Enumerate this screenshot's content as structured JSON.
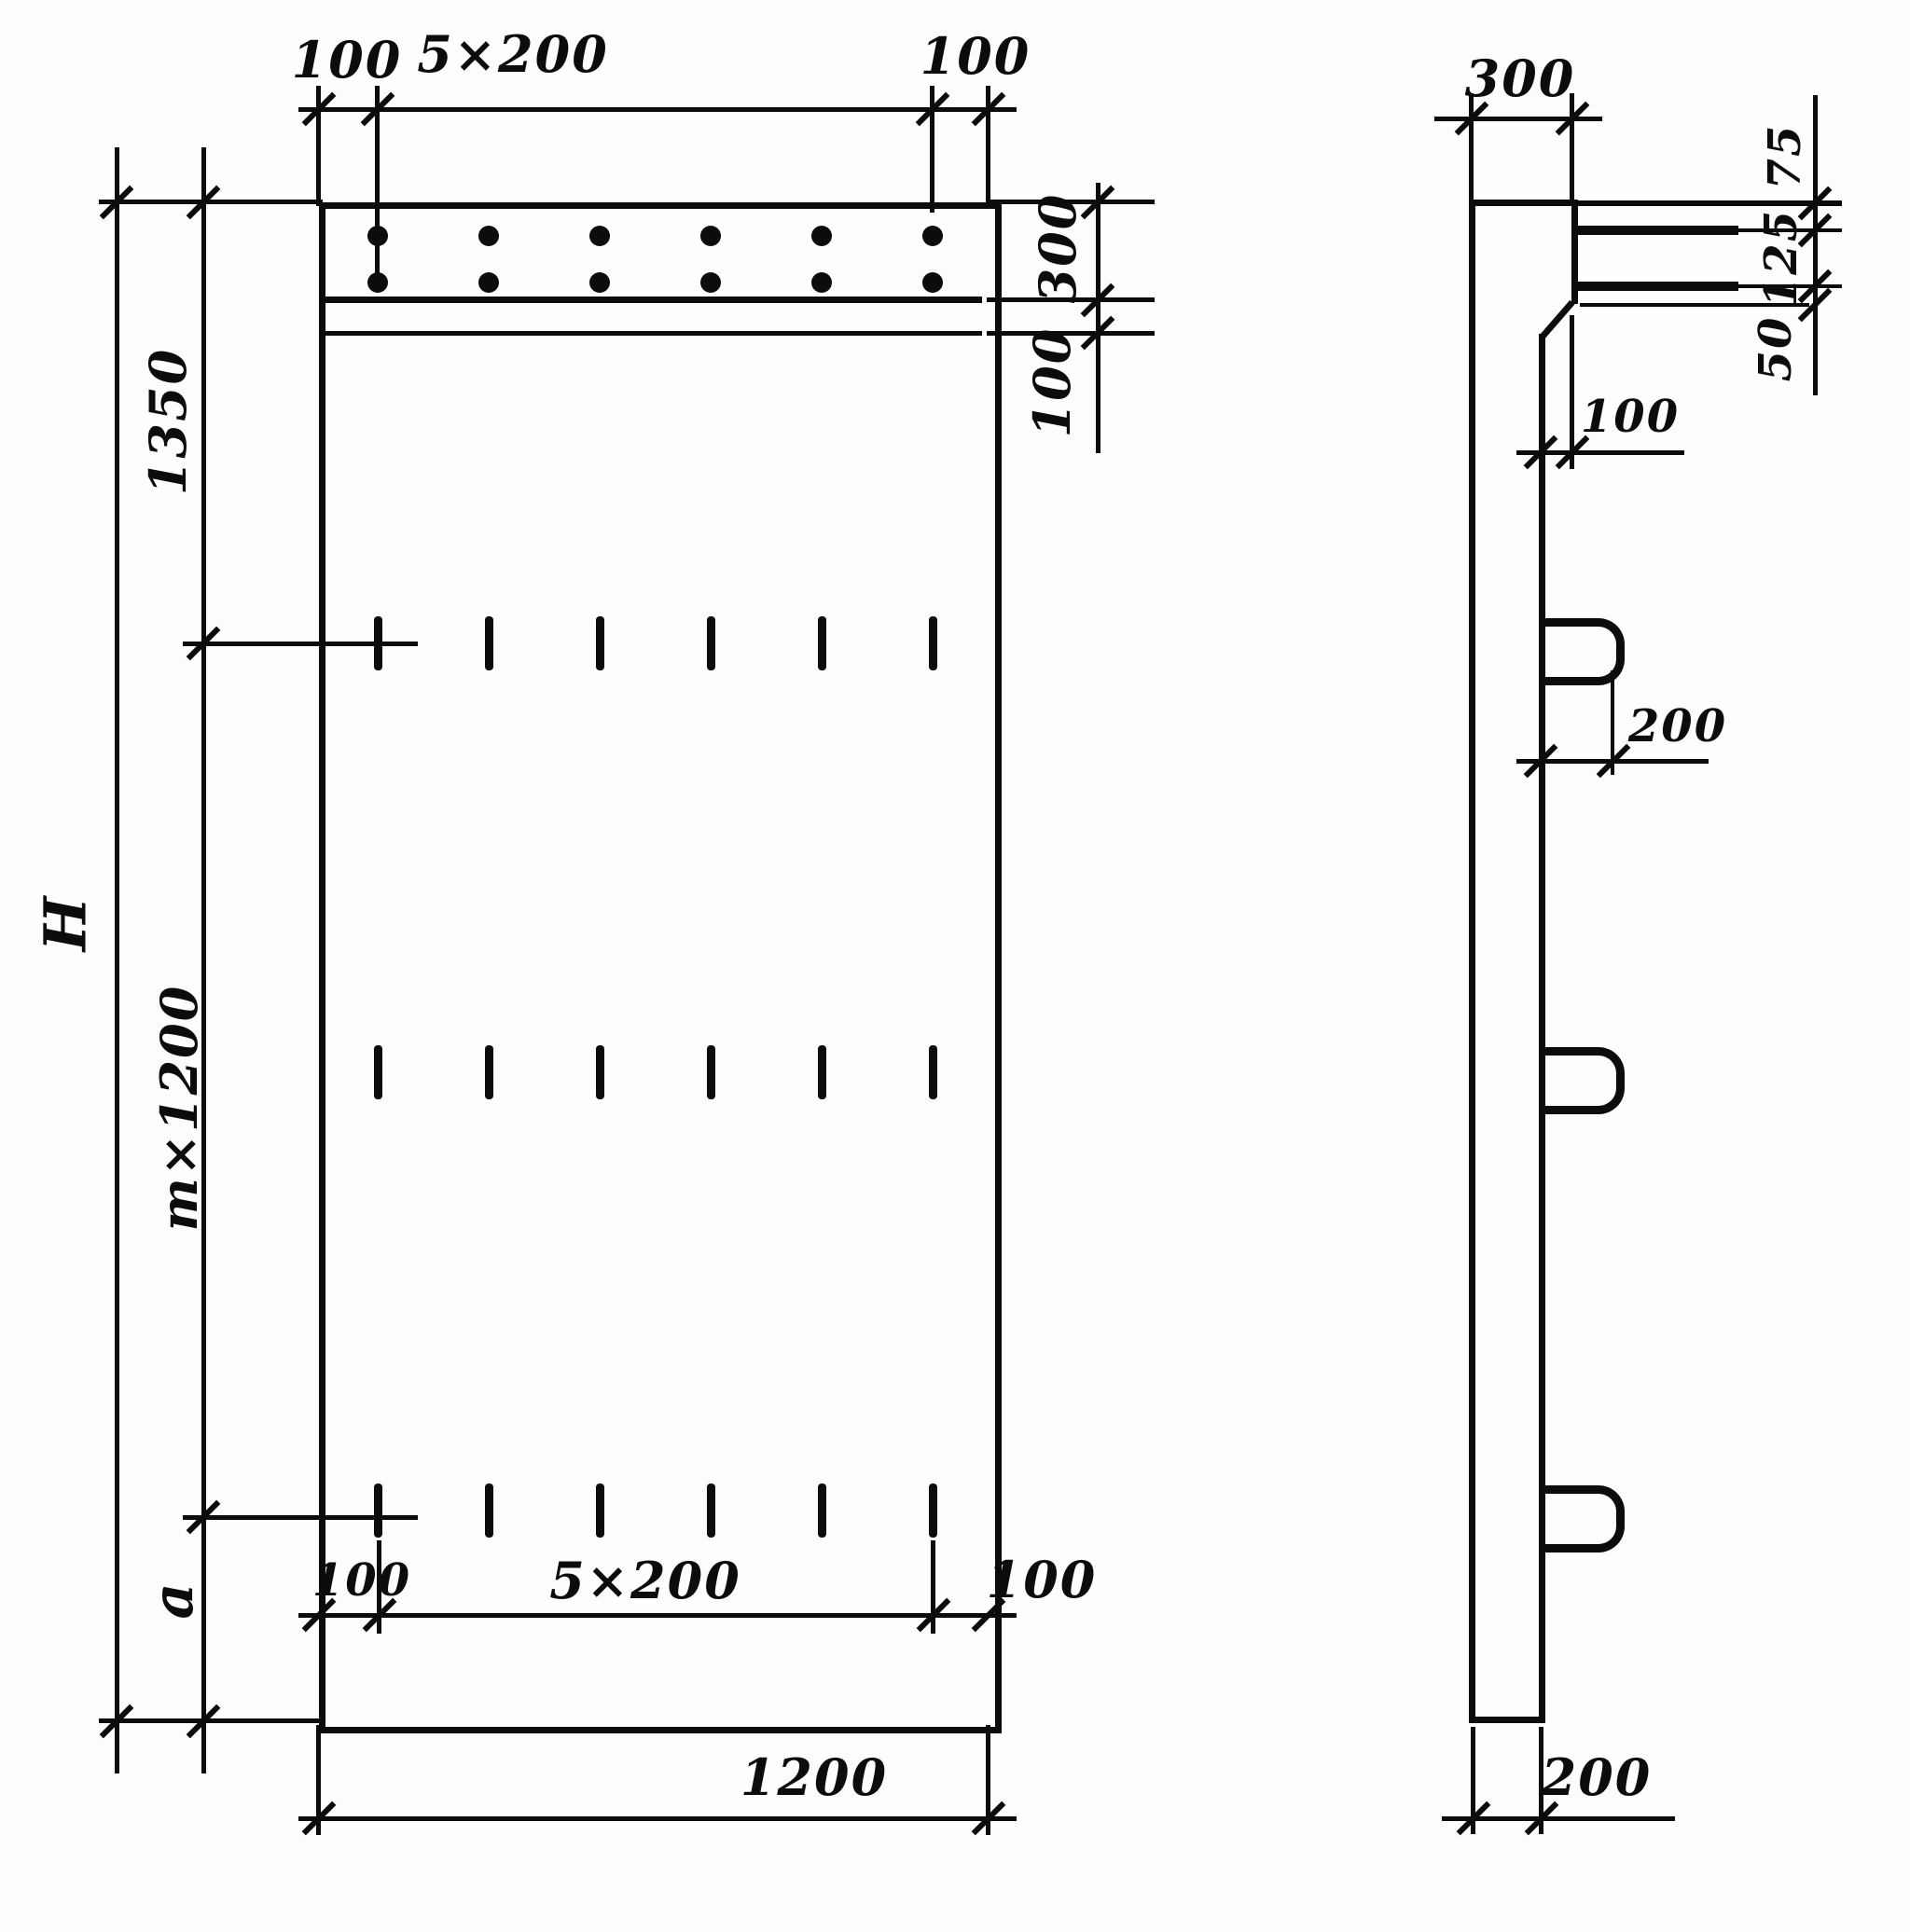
{
  "colors": {
    "ink": "#0c0c0c",
    "paper": "#fdfdfd"
  },
  "front_view": {
    "top_dims": {
      "left": "100",
      "middle": "5×200",
      "right": "100"
    },
    "right_dims": {
      "band_height": "300",
      "gap": "100"
    },
    "left_dims": {
      "top": "1350",
      "middle": "m×1200",
      "bottom": "a",
      "overall": "H"
    },
    "inner_bottom_dims": {
      "left": "100",
      "middle": "5×200",
      "right": "100"
    },
    "bottom_dim": {
      "width": "1200"
    }
  },
  "side_view": {
    "top_dim": {
      "thickness": "300"
    },
    "right_dims": {
      "seg1": "75",
      "seg2": "125",
      "seg3": "50"
    },
    "step_dim": "100",
    "loop_dim": "200",
    "bottom_dim": "200"
  }
}
